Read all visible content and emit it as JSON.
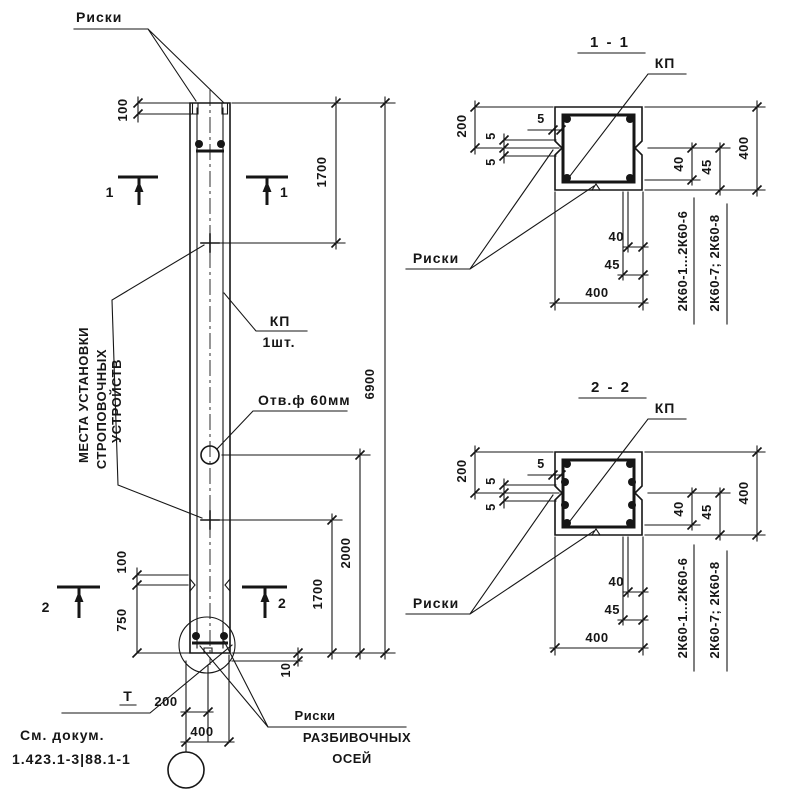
{
  "page": {
    "kind": "reinforced-concrete-column-working-drawing",
    "colors": {
      "ink": "#161616",
      "paper": "#ffffff"
    }
  },
  "elevation": {
    "riski_label": "Риски",
    "strop_note": [
      "МЕСТА УСТАНОВКИ",
      "СТРОПОВОЧНЫХ",
      "УСТРОЙСТВ"
    ],
    "kp_label": "КП",
    "kp_qty": "1шт.",
    "hole_label": "Отв.ф 60мм",
    "axis_riski_note": [
      "Риски",
      "РАЗБИВОЧНЫХ",
      "ОСЕЙ"
    ],
    "footnote_mark": "Т",
    "doc_ref": [
      "См. докум.",
      "1.423.1-3|88.1-1"
    ],
    "section_marks": {
      "s1": "1",
      "s2": "2"
    },
    "dims": {
      "top_offset": "100",
      "length_top": "1700",
      "overall": "6900",
      "to_hole": "2000",
      "length_bottom": "1700",
      "bottom_offset": "100",
      "base": "750",
      "base_riska": "10",
      "axis_half": "200",
      "width": "400"
    }
  },
  "sections": [
    {
      "title": "1 - 1",
      "kp_label": "КП",
      "riski_label": "Риски",
      "dims": {
        "half": "200",
        "cover": "5",
        "riska_up": "5",
        "riska_down": "5",
        "v40": "40",
        "v45": "45",
        "v400": "400",
        "h40": "40",
        "h45": "45",
        "h400": "400"
      },
      "applies_to": [
        "2К60-1...2К60-6",
        "2К60-7; 2К60-8"
      ]
    },
    {
      "title": "2 - 2",
      "kp_label": "КП",
      "riski_label": "Риски",
      "dims": {
        "half": "200",
        "cover": "5",
        "riska_up": "5",
        "riska_down": "5",
        "v40": "40",
        "v45": "45",
        "v400": "400",
        "h40": "40",
        "h45": "45",
        "h400": "400"
      },
      "applies_to": [
        "2К60-1...2К60-6",
        "2К60-7; 2К60-8"
      ]
    }
  ]
}
